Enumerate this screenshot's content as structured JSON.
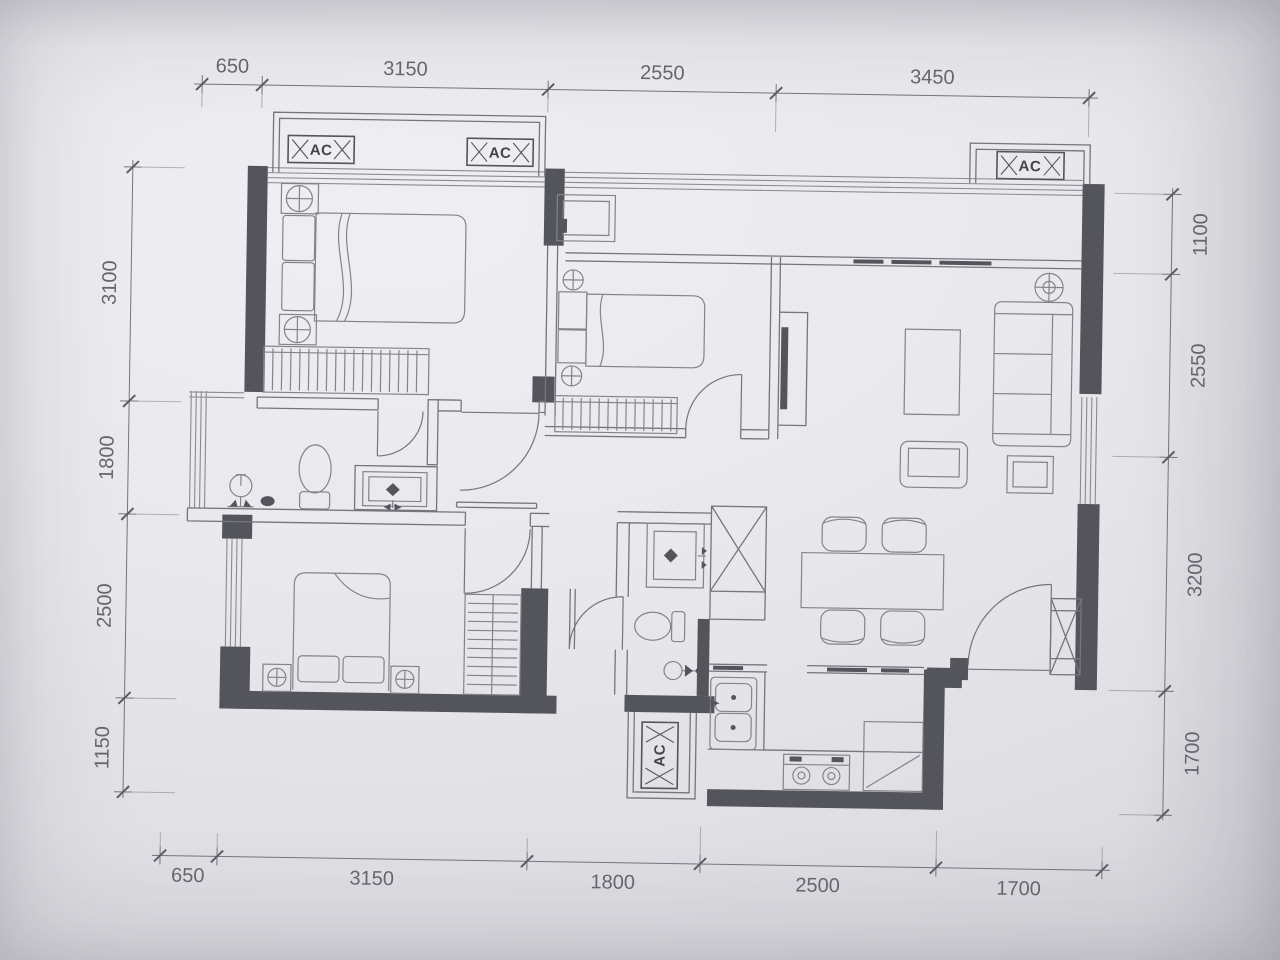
{
  "labels": {
    "ac": "AC"
  },
  "dimensions": {
    "top": [
      "650",
      "3150",
      "2550",
      "3450"
    ],
    "bottom": [
      "650",
      "3150",
      "1800",
      "2500",
      "1700"
    ],
    "left": [
      "3100",
      "1800",
      "2500",
      "1150"
    ],
    "right": [
      "1100",
      "2550",
      "3200",
      "1700"
    ]
  },
  "colors": {
    "paper": "#e8e7eb",
    "line": "#75757e",
    "wall": "#54545c",
    "furniture": "#83838b",
    "text": "#67676f",
    "accent_text": "#44444c",
    "win": "#8a8a93"
  }
}
